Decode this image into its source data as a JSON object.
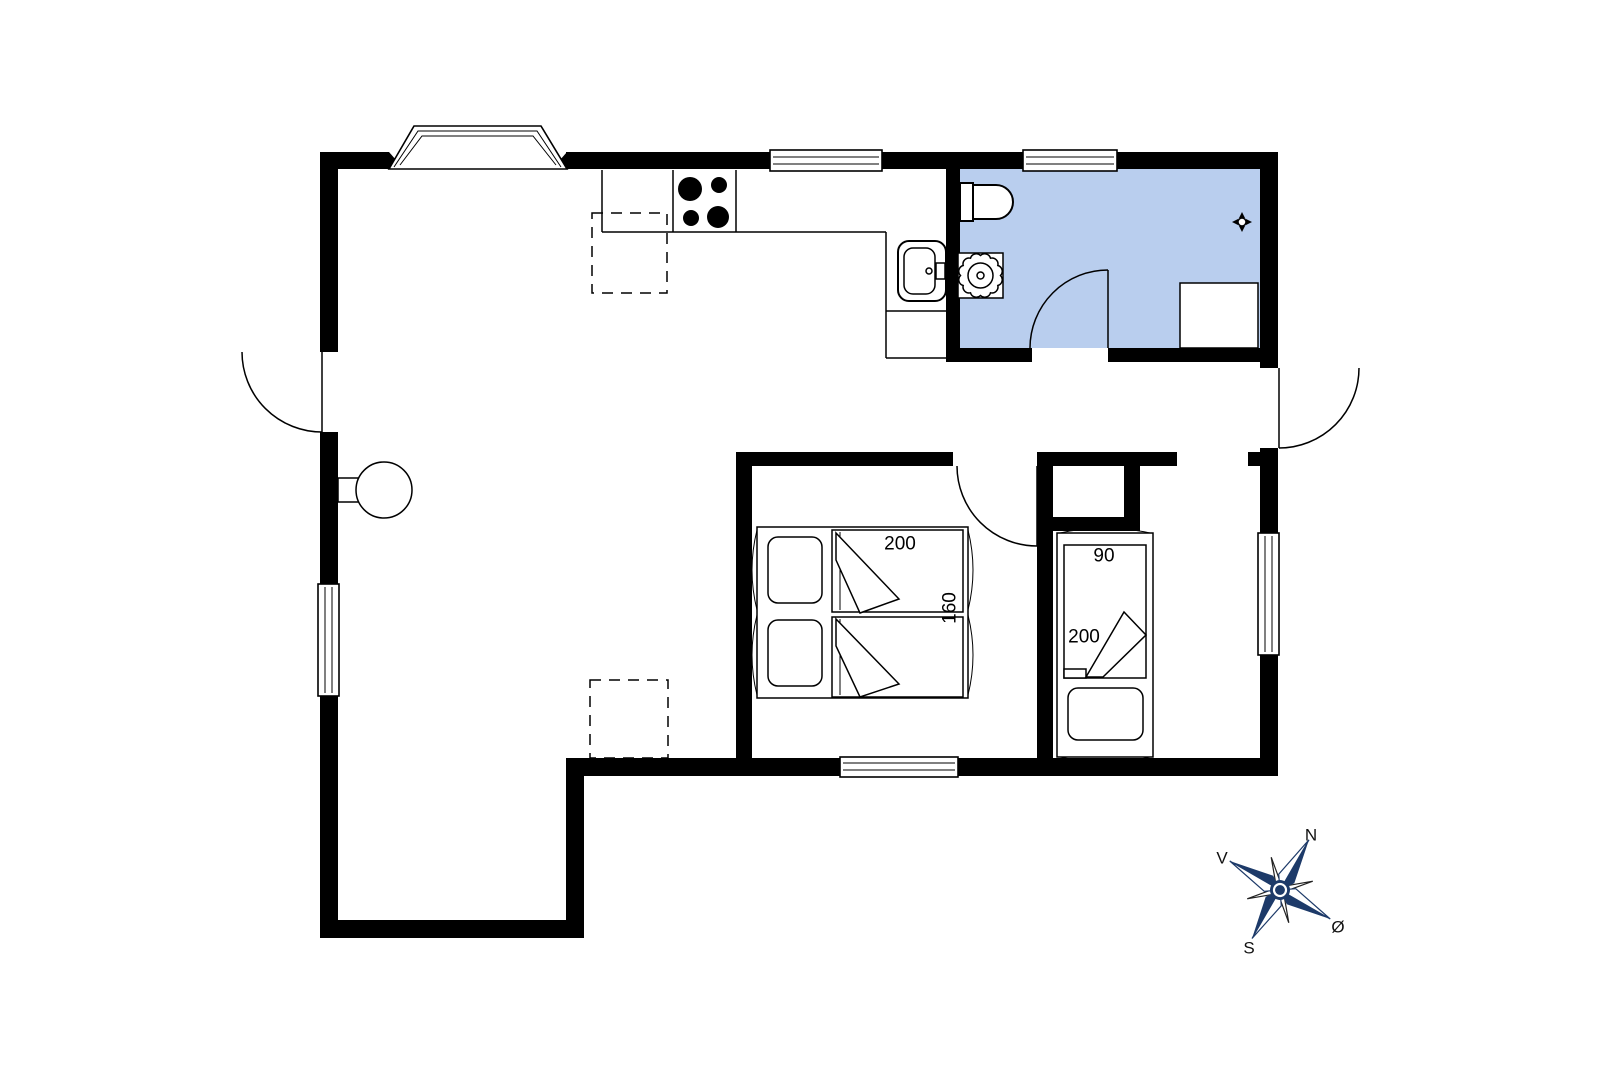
{
  "floorplan": {
    "bathroom_fill": "#b9ceee",
    "wall_color": "#000000",
    "compass_color": "#1d3a69",
    "double_bed": {
      "length_label": "200",
      "width_label": "160"
    },
    "single_bed": {
      "width_label": "90",
      "length_label": "200"
    },
    "compass": {
      "north": "N",
      "west": "V",
      "south": "S",
      "east": "Ø"
    },
    "icons": [
      "stove-burners",
      "kitchen-sink",
      "toilet",
      "washbasin",
      "floor-drain",
      "shower-cabinet",
      "wood-stove",
      "double-bed",
      "single-bed",
      "door-swing",
      "window",
      "bay-window",
      "compass-rose"
    ]
  }
}
